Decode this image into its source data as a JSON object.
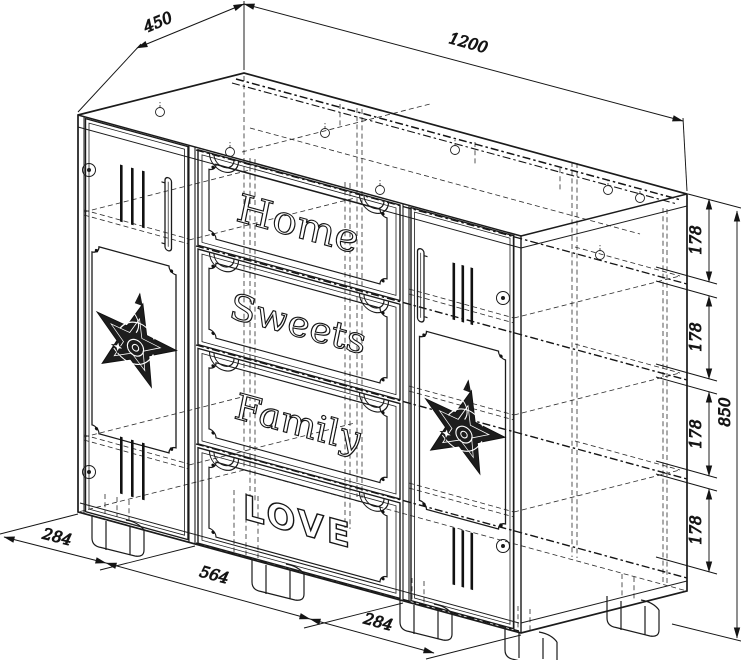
{
  "drawing": {
    "subject": "chest-of-drawers isometric technical drawing",
    "style": {
      "line_color": "#1b1b1b",
      "background": "#ffffff"
    }
  },
  "dimension_labels": {
    "depth": "450",
    "width": "1200",
    "height": "850",
    "pitch": [
      "178",
      "178",
      "178",
      "178"
    ],
    "bottom_left_width": "284",
    "bottom_center_width": "564",
    "bottom_right_width": "284"
  },
  "drawer_labels": [
    "Home",
    "Sweets",
    "Family",
    "LOVE"
  ]
}
